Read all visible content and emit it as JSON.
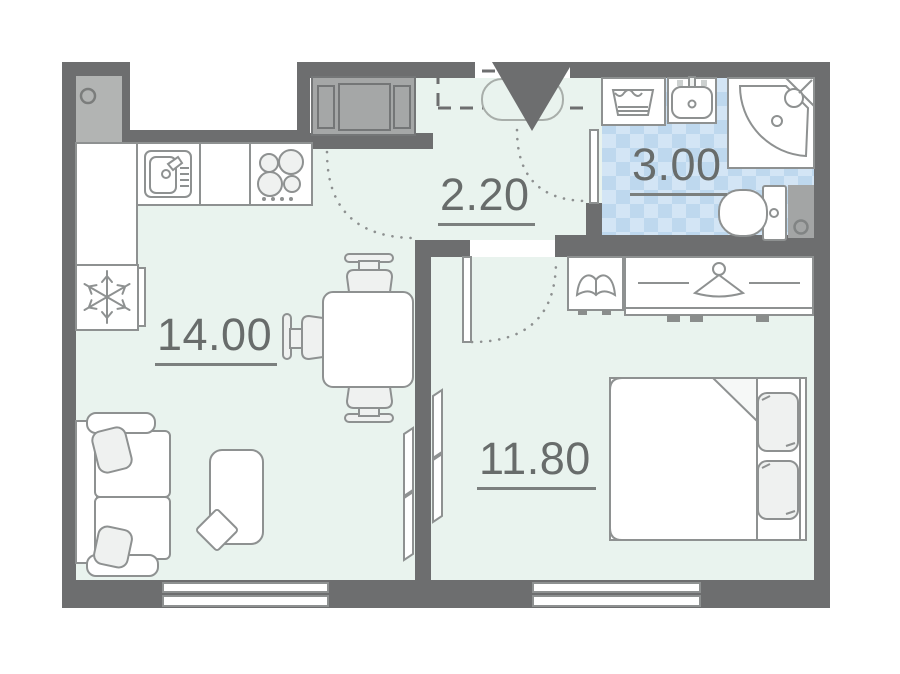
{
  "plan_title": "apartment-floor-plan",
  "rooms": {
    "living_kitchen": {
      "area": "14.00"
    },
    "hallway": {
      "area": "2.20"
    },
    "bathroom": {
      "area": "3.00"
    },
    "bedroom": {
      "area": "11.80"
    }
  },
  "colors": {
    "wall": "#6d6e6f",
    "floor": "#e9f3ee",
    "bathroom_floor": "#d3e5f5",
    "bathroom_floor_check": "#bed8ee",
    "furniture_outline": "#8e9191",
    "furniture_fill": "#ffffff",
    "soft_fill": "#eff1f0",
    "cabinet_gray": "#a5a7a7",
    "vent_gray": "#b2b4b3",
    "label_text": "#686c6b"
  },
  "icons": {
    "fridge": "snowflake-icon",
    "kitchen_sink": "sink-icon",
    "stove": "burners-icon",
    "hall_wardrobe": "cabinet-icon",
    "bedroom_wardrobe": "hanger-icon",
    "nightstand": "open-book-icon",
    "washing_machine": "laundry-basket-icon",
    "shower": "corner-shower-icon",
    "toilet": "toilet-icon",
    "entrance": "entrance-triangle-icon"
  }
}
